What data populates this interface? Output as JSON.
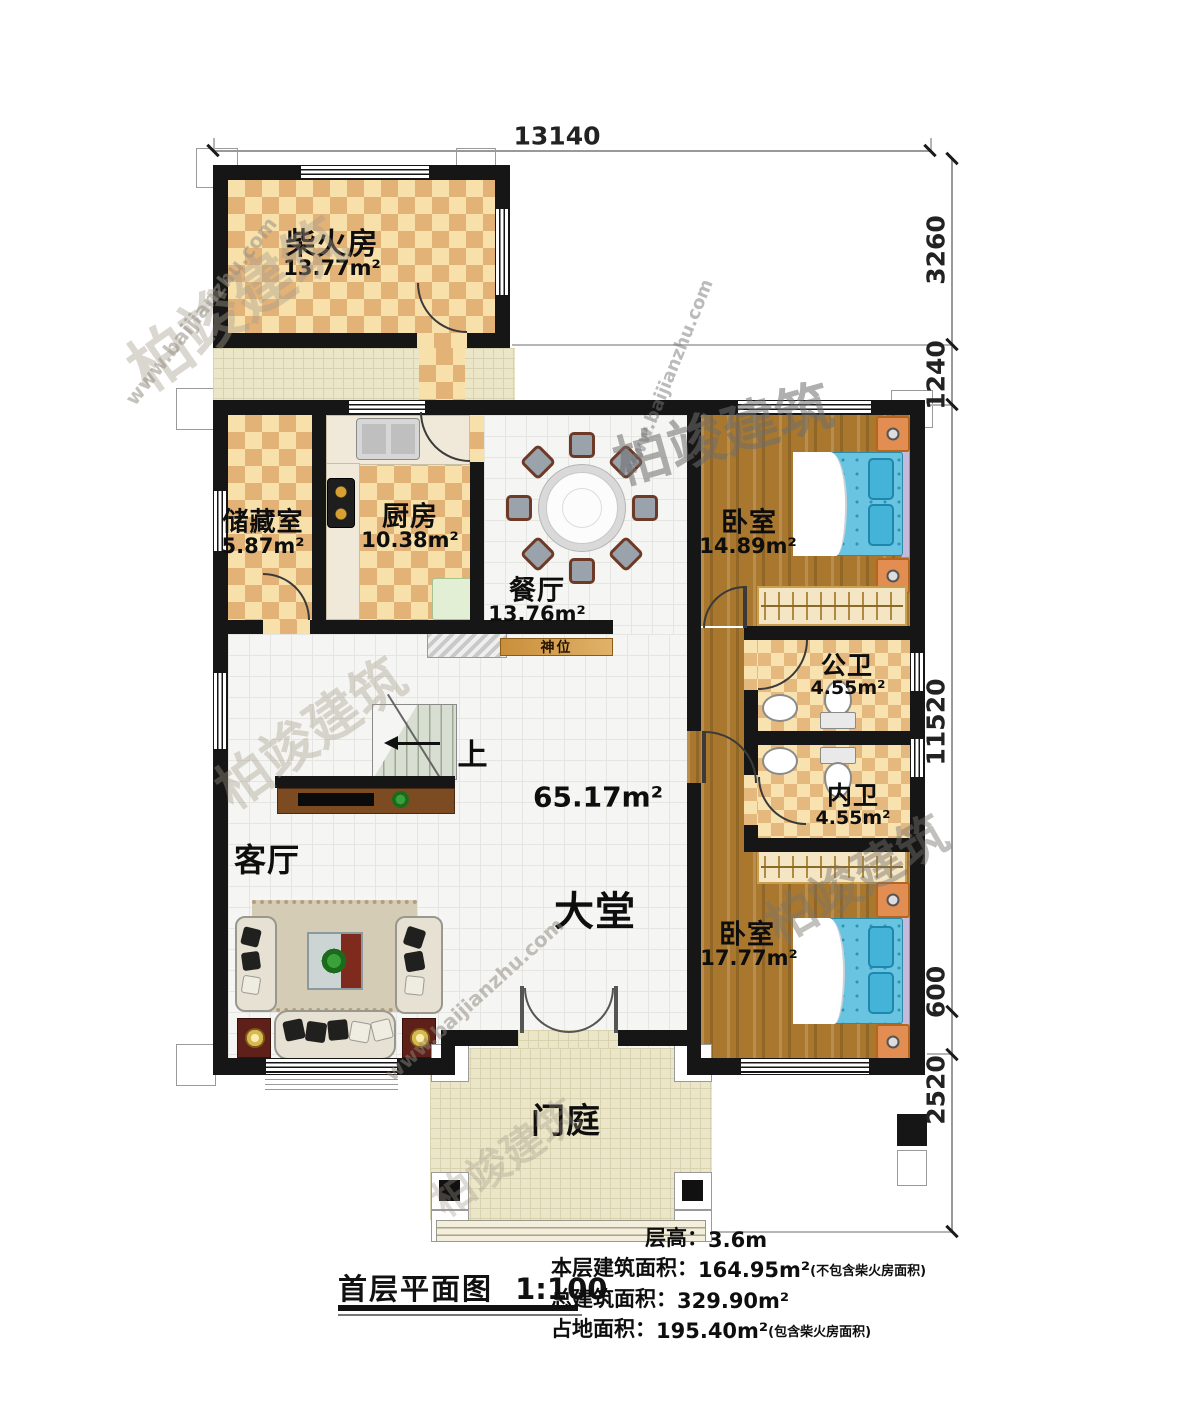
{
  "watermark": {
    "brand": "柏竣建筑",
    "url": "www.baijianzhu.com"
  },
  "dimensions": {
    "top": "13140",
    "right": [
      "3260",
      "1240",
      "11520",
      "600",
      "2520"
    ]
  },
  "rooms": {
    "firewood": {
      "name": "柴火房",
      "area": "13.77m²"
    },
    "storage": {
      "name": "储藏室",
      "area": "5.87m²"
    },
    "kitchen": {
      "name": "厨房",
      "area": "10.38m²"
    },
    "dining": {
      "name": "餐厅",
      "area": "13.76m²"
    },
    "bedroom1": {
      "name": "卧室",
      "area": "14.89m²"
    },
    "bath_public": {
      "name": "公卫",
      "area": "4.55m²"
    },
    "bath_private": {
      "name": "内卫",
      "area": "4.55m²"
    },
    "bedroom2": {
      "name": "卧室",
      "area": "17.77m²"
    },
    "living": {
      "name": "客厅"
    },
    "hall": {
      "name": "大堂",
      "area": "65.17m²"
    },
    "porch": {
      "name": "门庭"
    },
    "shrine": {
      "name": "神位"
    },
    "stairs": {
      "up_label": "上"
    }
  },
  "footer": {
    "title": "首层平面图",
    "scale": "1:100",
    "lines": [
      {
        "label": "层高：",
        "value": "3.6m",
        "note": ""
      },
      {
        "label": "本层建筑面积：",
        "value": "164.95m²",
        "note": "(不包含柴火房面积)"
      },
      {
        "label": "总建筑面积：",
        "value": "329.90m²",
        "note": ""
      },
      {
        "label": "占地面积：",
        "value": "195.40m²",
        "note": "(包含柴火房面积)"
      }
    ]
  }
}
